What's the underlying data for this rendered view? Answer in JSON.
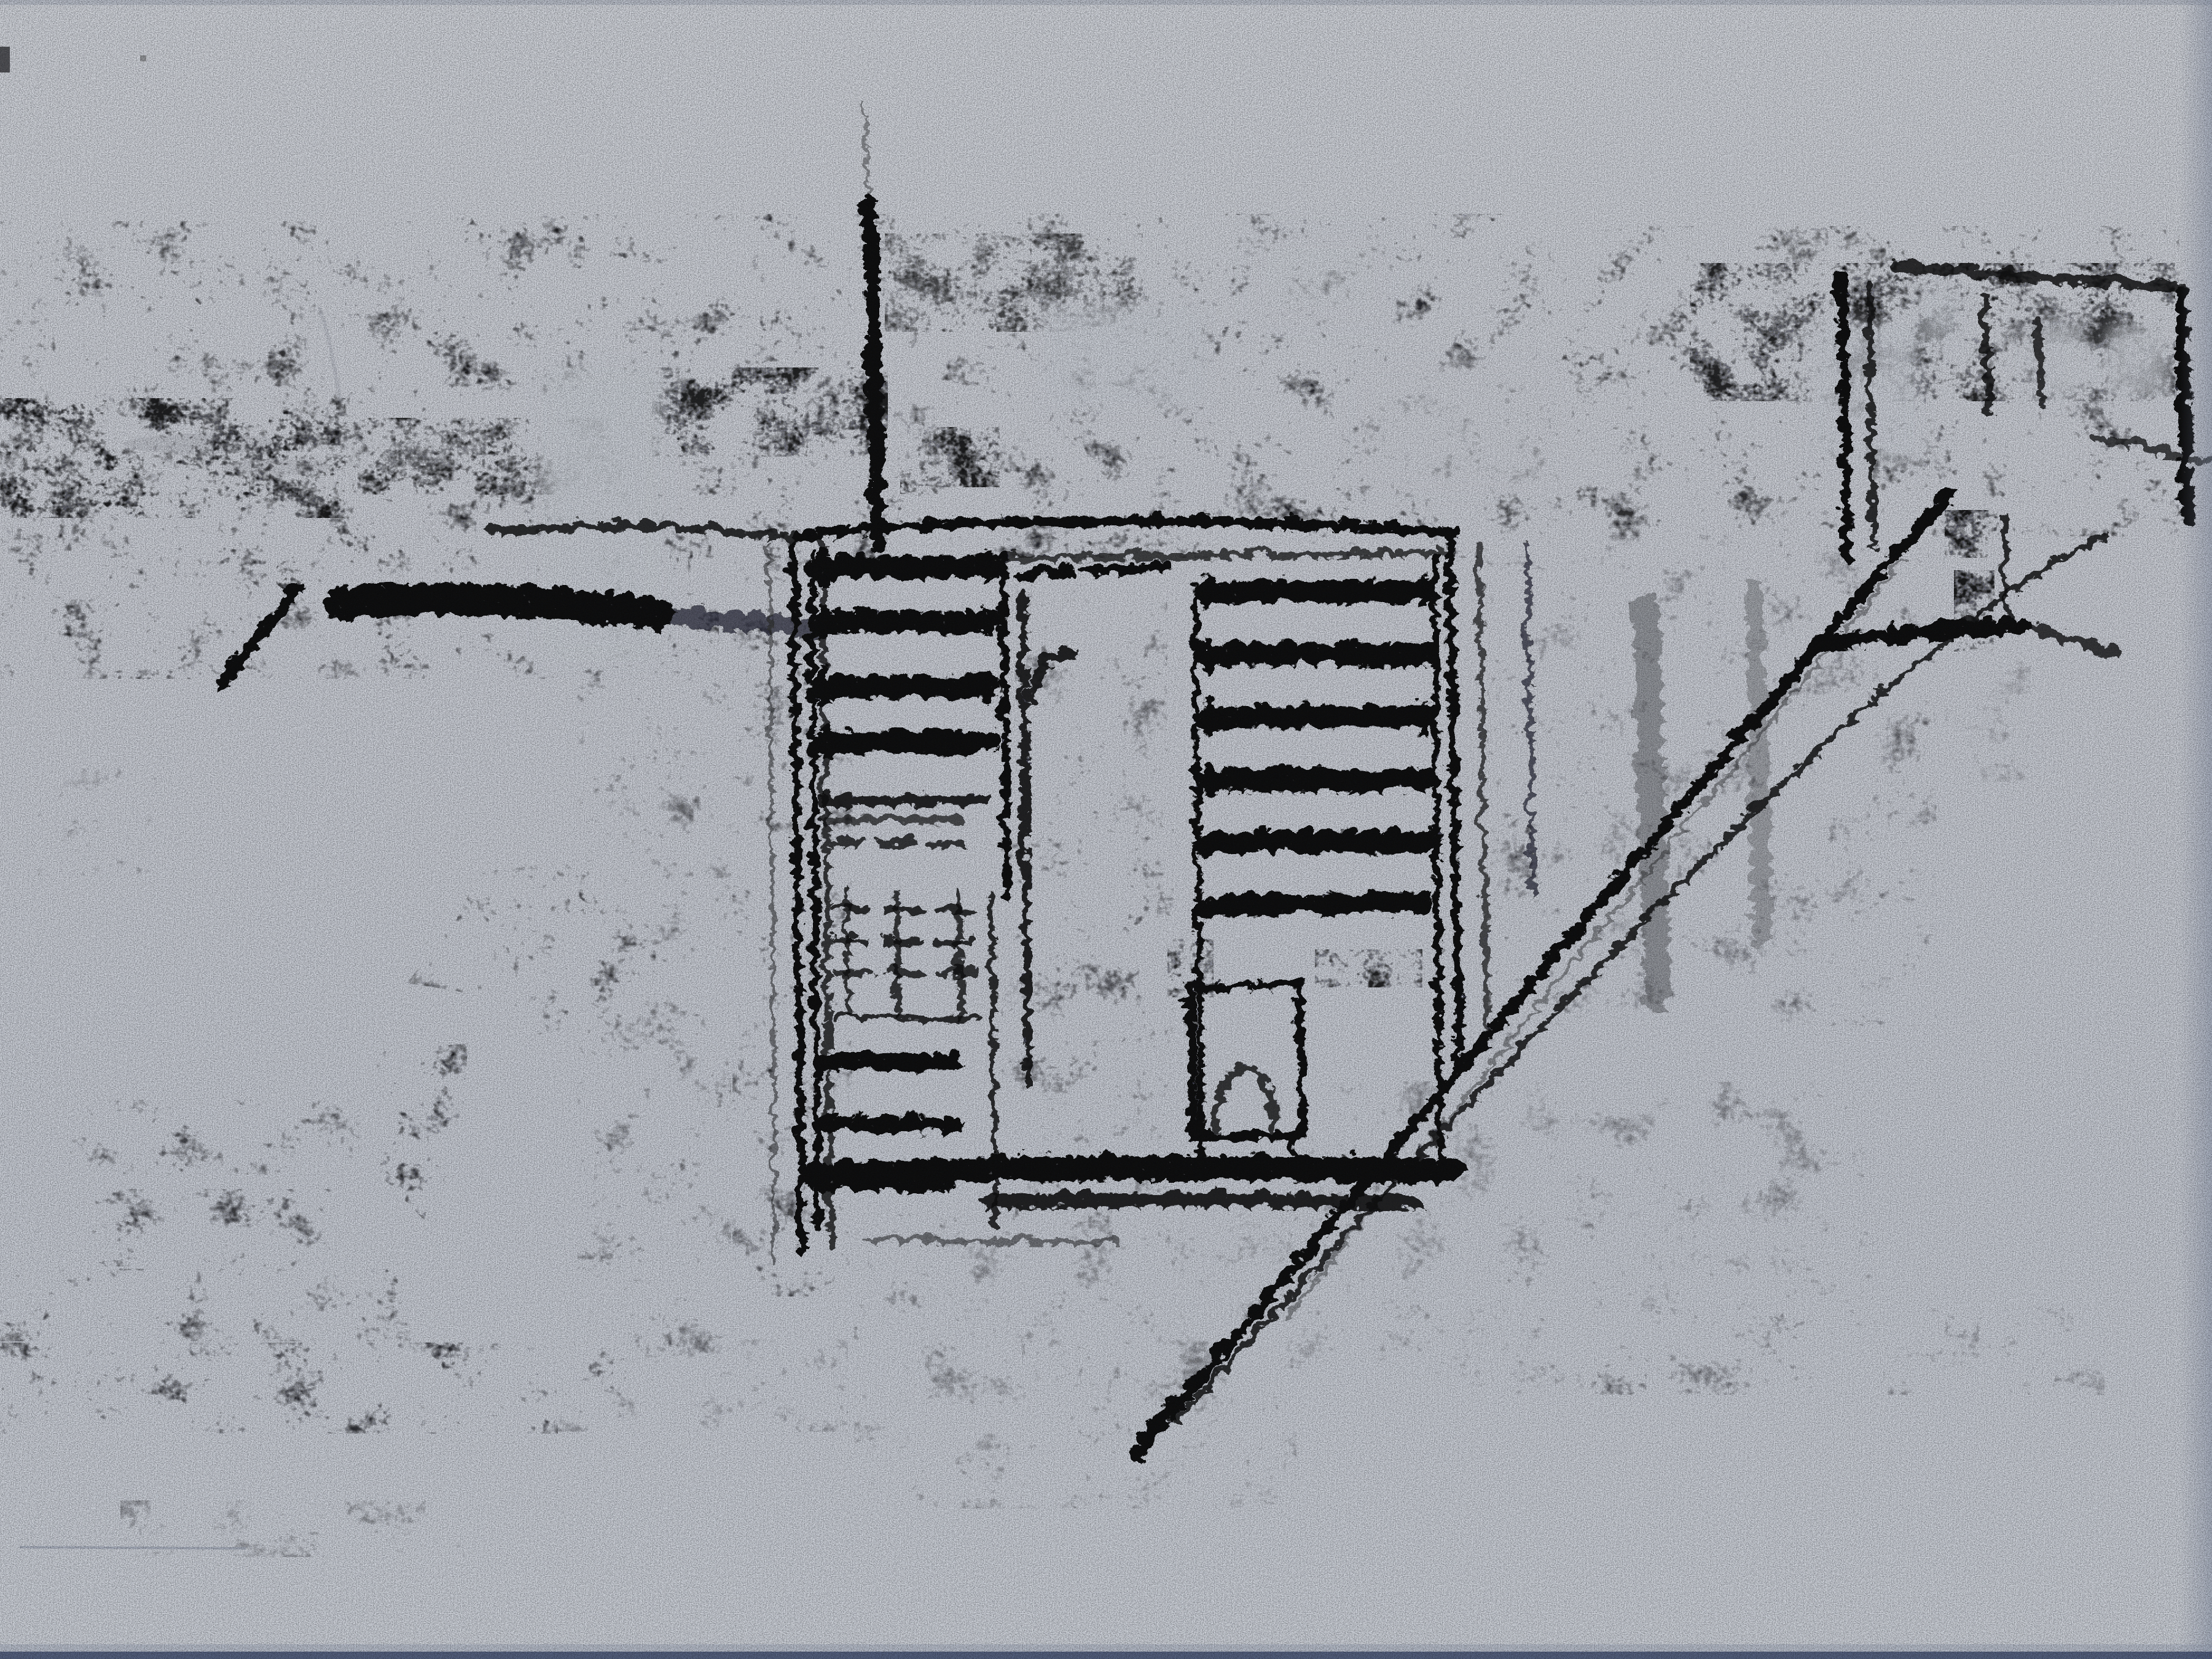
{
  "artwork": {
    "alt": "Photograph of a loose black charcoal sketch on light gray-blue paper. An aerial view of a street corner: a central rectangular structure with two columns of dark horizontal shutter slats, a vertical mast rising above it, wide grainy charcoal bands across the upper half, stacked textured blocks descending on the left, a small blocky building at upper right, and a long double diagonal cable stroke running from the upper right down to the lower center. The lower quarter of the paper is blank.",
    "medium": "charcoal on gray paper",
    "subject": "Charcoal sketch - aerial street corner with shuttered facade and diagonal cable",
    "palette": {
      "paper": "#c9cdd4",
      "paper_light": "#cfd2d8",
      "paper_deep": "#c6cad2",
      "charcoal_black": "#0a0a0b",
      "charcoal_dark": "#1b1b1e",
      "charcoal_mid": "#2e2e33",
      "charcoal_soft": "#55555a",
      "photo_edge_blue": "#3e4b6d",
      "edge_shadow": "#8892a6"
    },
    "elements": [
      "top charcoal texture band",
      "left stacked texture blocks",
      "thick left black bar stroke",
      "left pole stroke",
      "central shuttered structure",
      "left shutter slats",
      "middle scribbled divider",
      "right shutter slats",
      "small chair-like outline",
      "vertical mast stroke",
      "bottom double bar strokes",
      "diagonal cable double stroke",
      "upper-right blocky building",
      "bottom-right fading texture band",
      "blank paper margin"
    ]
  }
}
